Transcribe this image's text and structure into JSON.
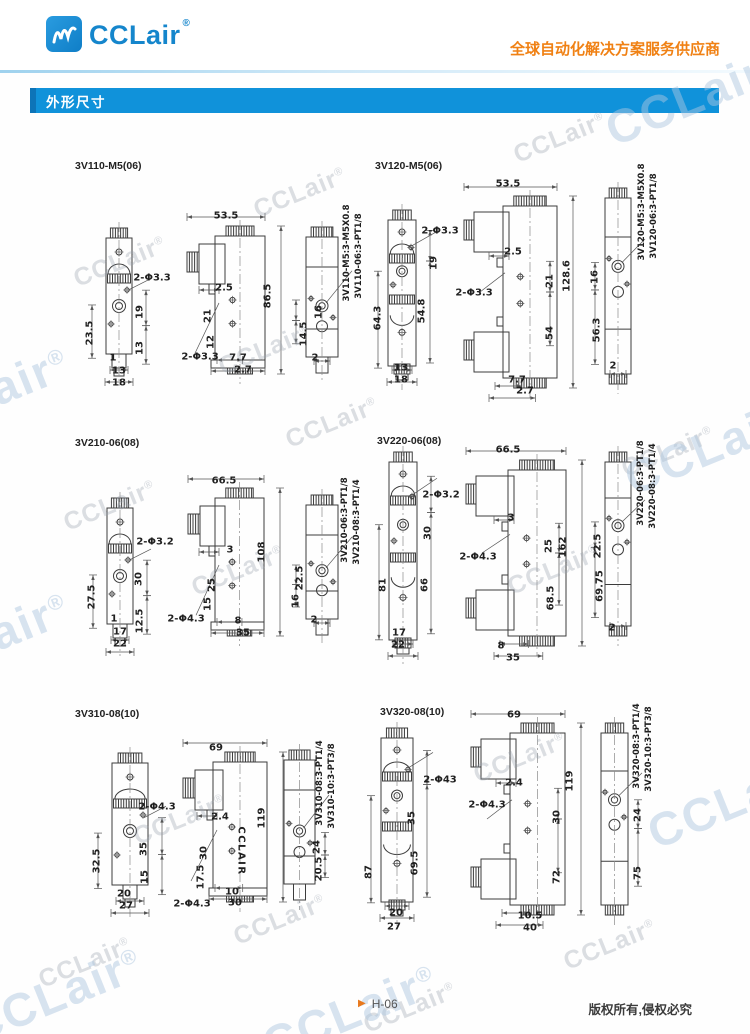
{
  "header": {
    "brand": "CCLair",
    "reg": "®",
    "tagline": "全球自动化解决方案服务供应商"
  },
  "section": {
    "title": "外形尺寸"
  },
  "watermark": {
    "text": "CCLair",
    "reg": "®"
  },
  "footer": {
    "page": "H-06",
    "copyright": "版权所有,侵权必究"
  },
  "figures": [
    {
      "title": "3V110-M5(06)",
      "labels": [
        {
          "t": "2-Φ3.3",
          "x": 152,
          "y": 278
        },
        {
          "t": "23.5",
          "x": 90,
          "y": 333,
          "r": -90
        },
        {
          "t": "19",
          "x": 140,
          "y": 312,
          "r": -90
        },
        {
          "t": "13",
          "x": 140,
          "y": 348,
          "r": -90
        },
        {
          "t": "1",
          "x": 113,
          "y": 358
        },
        {
          "t": "13",
          "x": 119,
          "y": 371
        },
        {
          "t": "18",
          "x": 119,
          "y": 383
        },
        {
          "t": "53.5",
          "x": 226,
          "y": 216
        },
        {
          "t": "86.5",
          "x": 268,
          "y": 296,
          "r": -90
        },
        {
          "t": "2.5",
          "x": 224,
          "y": 288
        },
        {
          "t": "21",
          "x": 208,
          "y": 316,
          "r": -90
        },
        {
          "t": "12",
          "x": 211,
          "y": 342,
          "r": -90
        },
        {
          "t": "2-Φ3.3",
          "x": 200,
          "y": 357
        },
        {
          "t": "7.7",
          "x": 238,
          "y": 358
        },
        {
          "t": "2.7",
          "x": 243,
          "y": 370
        },
        {
          "t": "3V110-M5:3-M5X0.8",
          "x": 347,
          "y": 253,
          "r": -90
        },
        {
          "t": "3V110-06:3-PT1/8",
          "x": 359,
          "y": 256,
          "r": -90
        },
        {
          "t": "16",
          "x": 319,
          "y": 312,
          "r": -90
        },
        {
          "t": "14.5",
          "x": 304,
          "y": 334,
          "r": -90
        },
        {
          "t": "2",
          "x": 315,
          "y": 358
        }
      ]
    },
    {
      "title": "3V120-M5(06)",
      "labels": [
        {
          "t": "2-Φ3.3",
          "x": 440,
          "y": 231
        },
        {
          "t": "19",
          "x": 434,
          "y": 263,
          "r": -90
        },
        {
          "t": "64.3",
          "x": 378,
          "y": 318,
          "r": -90
        },
        {
          "t": "54.8",
          "x": 422,
          "y": 311,
          "r": -90
        },
        {
          "t": "13",
          "x": 401,
          "y": 368
        },
        {
          "t": "18",
          "x": 401,
          "y": 380
        },
        {
          "t": "53.5",
          "x": 508,
          "y": 184
        },
        {
          "t": "128.6",
          "x": 567,
          "y": 276,
          "r": -90
        },
        {
          "t": "2.5",
          "x": 513,
          "y": 252
        },
        {
          "t": "21",
          "x": 550,
          "y": 281,
          "r": -90
        },
        {
          "t": "54",
          "x": 550,
          "y": 333,
          "r": -90
        },
        {
          "t": "2-Φ3.3",
          "x": 474,
          "y": 293
        },
        {
          "t": "7.7",
          "x": 517,
          "y": 380
        },
        {
          "t": "2.7",
          "x": 525,
          "y": 391
        },
        {
          "t": "3V120-M5:3-M5X0.8",
          "x": 642,
          "y": 212,
          "r": -90
        },
        {
          "t": "3V120-06:3-PT1/8",
          "x": 654,
          "y": 216,
          "r": -90
        },
        {
          "t": "16",
          "x": 595,
          "y": 277,
          "r": -90
        },
        {
          "t": "56.3",
          "x": 597,
          "y": 330,
          "r": -90
        },
        {
          "t": "2",
          "x": 613,
          "y": 366
        }
      ]
    },
    {
      "title": "3V210-06(08)",
      "labels": [
        {
          "t": "2-Φ3.2",
          "x": 155,
          "y": 542
        },
        {
          "t": "27.5",
          "x": 92,
          "y": 597,
          "r": -90
        },
        {
          "t": "30",
          "x": 139,
          "y": 579,
          "r": -90
        },
        {
          "t": "12.5",
          "x": 140,
          "y": 621,
          "r": -90
        },
        {
          "t": "1",
          "x": 114,
          "y": 619
        },
        {
          "t": "17",
          "x": 120,
          "y": 632
        },
        {
          "t": "22",
          "x": 120,
          "y": 644
        },
        {
          "t": "66.5",
          "x": 224,
          "y": 481
        },
        {
          "t": "108",
          "x": 262,
          "y": 552,
          "r": -90
        },
        {
          "t": "3",
          "x": 230,
          "y": 550
        },
        {
          "t": "25",
          "x": 212,
          "y": 585,
          "r": -90
        },
        {
          "t": "15",
          "x": 208,
          "y": 604,
          "r": -90
        },
        {
          "t": "2-Φ4.3",
          "x": 186,
          "y": 619
        },
        {
          "t": "8",
          "x": 238,
          "y": 621
        },
        {
          "t": "35",
          "x": 243,
          "y": 633
        },
        {
          "t": "3V210-06:3-PT1/8",
          "x": 345,
          "y": 520,
          "r": -90
        },
        {
          "t": "3V210-08:3-PT1/4",
          "x": 357,
          "y": 522,
          "r": -90
        },
        {
          "t": "22.5",
          "x": 300,
          "y": 578,
          "r": -90
        },
        {
          "t": "16",
          "x": 296,
          "y": 601,
          "r": -90
        },
        {
          "t": "2",
          "x": 314,
          "y": 620
        }
      ]
    },
    {
      "title": "3V220-06(08)",
      "labels": [
        {
          "t": "2-Φ3.2",
          "x": 441,
          "y": 495
        },
        {
          "t": "30",
          "x": 428,
          "y": 533,
          "r": -90
        },
        {
          "t": "81",
          "x": 383,
          "y": 585,
          "r": -90
        },
        {
          "t": "66",
          "x": 425,
          "y": 585,
          "r": -90
        },
        {
          "t": "17",
          "x": 399,
          "y": 633
        },
        {
          "t": "22",
          "x": 398,
          "y": 645
        },
        {
          "t": "66.5",
          "x": 508,
          "y": 450
        },
        {
          "t": "162",
          "x": 563,
          "y": 547,
          "r": -90
        },
        {
          "t": "3",
          "x": 511,
          "y": 518
        },
        {
          "t": "25",
          "x": 549,
          "y": 546,
          "r": -90
        },
        {
          "t": "68.5",
          "x": 551,
          "y": 598,
          "r": -90
        },
        {
          "t": "2-Φ4.3",
          "x": 478,
          "y": 557
        },
        {
          "t": "8",
          "x": 501,
          "y": 646
        },
        {
          "t": "35",
          "x": 513,
          "y": 658
        },
        {
          "t": "3V220-06:3-PT1/8",
          "x": 641,
          "y": 483,
          "r": -90
        },
        {
          "t": "3V220-08:3-PT1/4",
          "x": 653,
          "y": 486,
          "r": -90
        },
        {
          "t": "22.5",
          "x": 598,
          "y": 546,
          "r": -90
        },
        {
          "t": "69.75",
          "x": 600,
          "y": 586,
          "r": -90
        },
        {
          "t": "2",
          "x": 612,
          "y": 628
        }
      ]
    },
    {
      "title": "3V310-08(10)",
      "labels": [
        {
          "t": "2-Φ4.3",
          "x": 157,
          "y": 807
        },
        {
          "t": "32.5",
          "x": 97,
          "y": 861,
          "r": -90
        },
        {
          "t": "35",
          "x": 144,
          "y": 849,
          "r": -90
        },
        {
          "t": "15",
          "x": 145,
          "y": 877,
          "r": -90
        },
        {
          "t": "20",
          "x": 124,
          "y": 894
        },
        {
          "t": "27",
          "x": 126,
          "y": 906
        },
        {
          "t": "69",
          "x": 216,
          "y": 748
        },
        {
          "t": "119",
          "x": 262,
          "y": 818,
          "r": -90
        },
        {
          "t": "2.4",
          "x": 220,
          "y": 817
        },
        {
          "t": "30",
          "x": 204,
          "y": 853,
          "r": -90
        },
        {
          "t": "17.5",
          "x": 201,
          "y": 877,
          "r": -90
        },
        {
          "t": "CCLAIR",
          "x": 241,
          "y": 851,
          "r": 90
        },
        {
          "t": "10",
          "x": 232,
          "y": 892
        },
        {
          "t": "30",
          "x": 235,
          "y": 903
        },
        {
          "t": "2-Φ4.3",
          "x": 192,
          "y": 904
        },
        {
          "t": "3V310-08:3-PT1/4",
          "x": 320,
          "y": 783,
          "r": -90
        },
        {
          "t": "3V310-10:3-PT3/8",
          "x": 332,
          "y": 786,
          "r": -90
        },
        {
          "t": "24",
          "x": 317,
          "y": 847,
          "r": -90
        },
        {
          "t": "20.5",
          "x": 319,
          "y": 869,
          "r": -90
        }
      ]
    },
    {
      "title": "3V320-08(10)",
      "labels": [
        {
          "t": "2-Φ43",
          "x": 440,
          "y": 780
        },
        {
          "t": "35",
          "x": 412,
          "y": 818,
          "r": -90
        },
        {
          "t": "87",
          "x": 369,
          "y": 872,
          "r": -90
        },
        {
          "t": "69.5",
          "x": 415,
          "y": 863,
          "r": -90
        },
        {
          "t": "20",
          "x": 396,
          "y": 913
        },
        {
          "t": "27",
          "x": 394,
          "y": 927
        },
        {
          "t": "69",
          "x": 514,
          "y": 715
        },
        {
          "t": "119",
          "x": 570,
          "y": 781,
          "r": -90
        },
        {
          "t": "2.4",
          "x": 514,
          "y": 783
        },
        {
          "t": "2-Φ4.3",
          "x": 487,
          "y": 805
        },
        {
          "t": "30",
          "x": 557,
          "y": 817,
          "r": -90
        },
        {
          "t": "72",
          "x": 557,
          "y": 877,
          "r": -90
        },
        {
          "t": "10.5",
          "x": 530,
          "y": 916
        },
        {
          "t": "40",
          "x": 530,
          "y": 928
        },
        {
          "t": "3V320-08:3-PT1/4",
          "x": 637,
          "y": 746,
          "r": -90
        },
        {
          "t": "3V320-10:3-PT3/8",
          "x": 649,
          "y": 749,
          "r": -90
        },
        {
          "t": "24",
          "x": 638,
          "y": 815,
          "r": -90
        },
        {
          "t": "75",
          "x": 638,
          "y": 873,
          "r": -90
        }
      ]
    }
  ]
}
